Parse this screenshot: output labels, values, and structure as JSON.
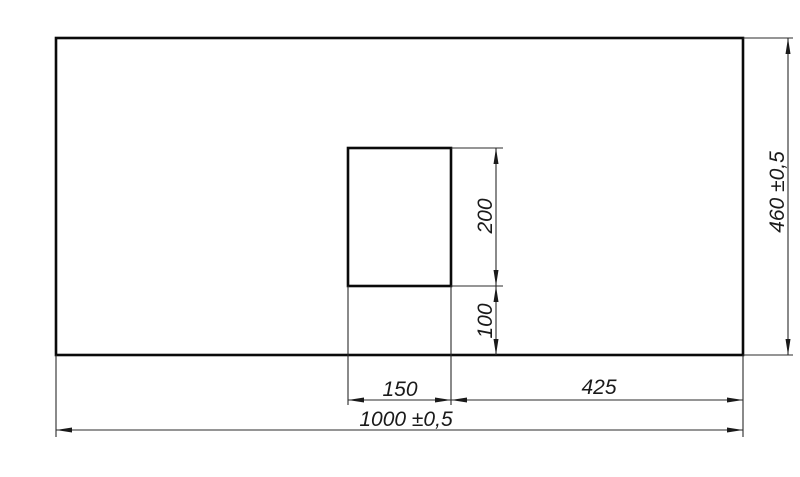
{
  "page": {
    "background_color": "#ffffff",
    "line_color": "#1a1a1a",
    "text_color": "#1a1a1a"
  },
  "drawing": {
    "kind": "dimensioned-technical-drawing",
    "labels": {
      "total_width": "1000 ±0,5",
      "total_height": "460 ±0,5",
      "cutout_width": "150",
      "cutout_height": "200",
      "cutout_bottom_offset": "100",
      "cutout_right_offset": "425"
    }
  }
}
